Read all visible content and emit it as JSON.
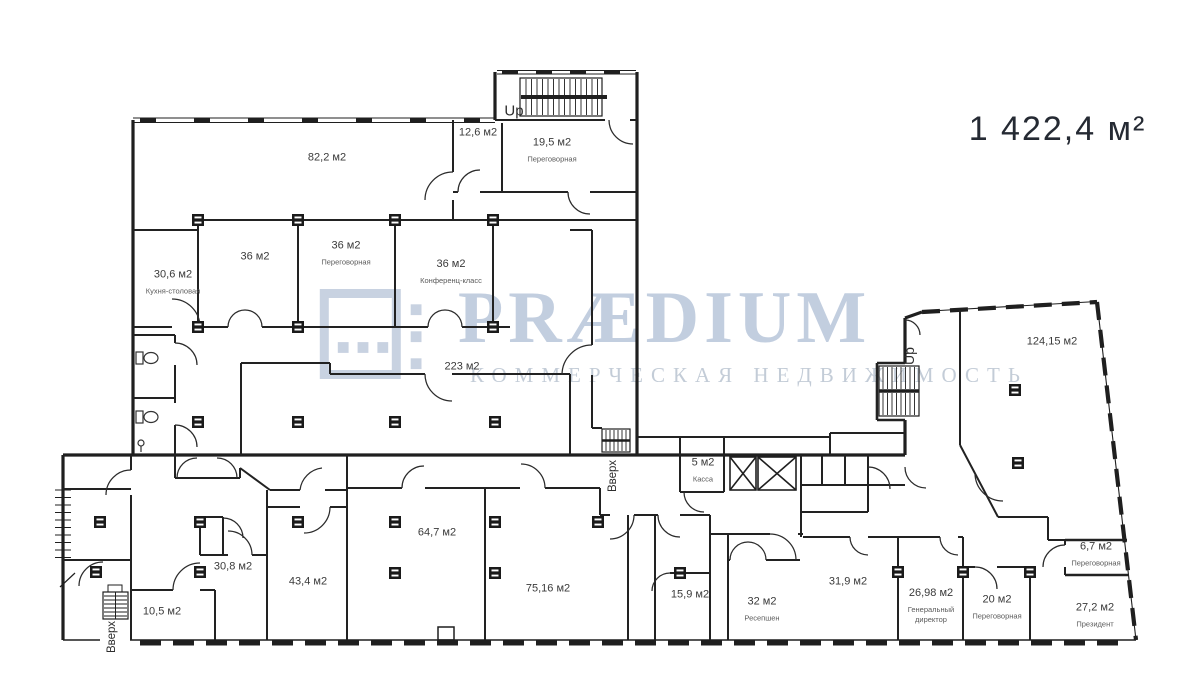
{
  "total_area": "1 422,4 м²",
  "watermark": {
    "brand": "PRÆDIUM",
    "tagline": "КОММЕРЧЕСКАЯ НЕДВИЖИМОСТЬ",
    "brand_color": "#b3c2d8",
    "tagline_color": "#bdc7d3",
    "logo_icon": "praedium-grid-logo"
  },
  "colors": {
    "walls": "#1f1f1f",
    "room_text": "#3a3a3a",
    "total_area_text": "#252a33",
    "background": "#ffffff"
  },
  "plan": {
    "rooms": [
      {
        "area": "82,2 м2",
        "name": "",
        "x": 327,
        "y": 158
      },
      {
        "area": "12,6 м2",
        "name": "",
        "x": 478,
        "y": 133
      },
      {
        "area": "19,5 м2",
        "name": "Переговорная",
        "x": 552,
        "y": 150
      },
      {
        "area": "30,6 м2",
        "name": "Кухня-столовая",
        "x": 173,
        "y": 282
      },
      {
        "area": "36 м2",
        "name": "",
        "x": 255,
        "y": 257
      },
      {
        "area": "36 м2",
        "name": "Переговорная",
        "x": 346,
        "y": 253
      },
      {
        "area": "36 м2",
        "name": "Конференц-класс",
        "x": 451,
        "y": 272
      },
      {
        "area": "223 м2",
        "name": "",
        "x": 462,
        "y": 367
      },
      {
        "area": "124,15 м2",
        "name": "",
        "x": 1052,
        "y": 342
      },
      {
        "area": "5 м2",
        "name": "Касса",
        "x": 703,
        "y": 470
      },
      {
        "area": "10,5 м2",
        "name": "",
        "x": 162,
        "y": 612
      },
      {
        "area": "30,8 м2",
        "name": "",
        "x": 233,
        "y": 567
      },
      {
        "area": "43,4 м2",
        "name": "",
        "x": 308,
        "y": 582
      },
      {
        "area": "64,7 м2",
        "name": "",
        "x": 437,
        "y": 533
      },
      {
        "area": "75,16 м2",
        "name": "",
        "x": 548,
        "y": 589
      },
      {
        "area": "15,9 м2",
        "name": "",
        "x": 690,
        "y": 595
      },
      {
        "area": "32 м2",
        "name": "Ресепшен",
        "x": 762,
        "y": 609
      },
      {
        "area": "31,9 м2",
        "name": "",
        "x": 848,
        "y": 582
      },
      {
        "area": "26,98 м2",
        "name": "Генеральный директор",
        "x": 931,
        "y": 606
      },
      {
        "area": "20 м2",
        "name": "Переговорная",
        "x": 997,
        "y": 607
      },
      {
        "area": "27,2 м2",
        "name": "Президент",
        "x": 1095,
        "y": 615
      },
      {
        "area": "6,7 м2",
        "name": "Переговорная",
        "x": 1096,
        "y": 554
      }
    ],
    "stair_labels": [
      {
        "text": "Up",
        "x": 514,
        "y": 111,
        "rotate": 0,
        "size": 15
      },
      {
        "text": "Up",
        "x": 909,
        "y": 356,
        "rotate": -90,
        "size": 14
      },
      {
        "text": "Вверх",
        "x": 613,
        "y": 476,
        "rotate": -90,
        "size": 11.5
      },
      {
        "text": "Вверх",
        "x": 112,
        "y": 637,
        "rotate": -90,
        "size": 11.5
      }
    ]
  }
}
